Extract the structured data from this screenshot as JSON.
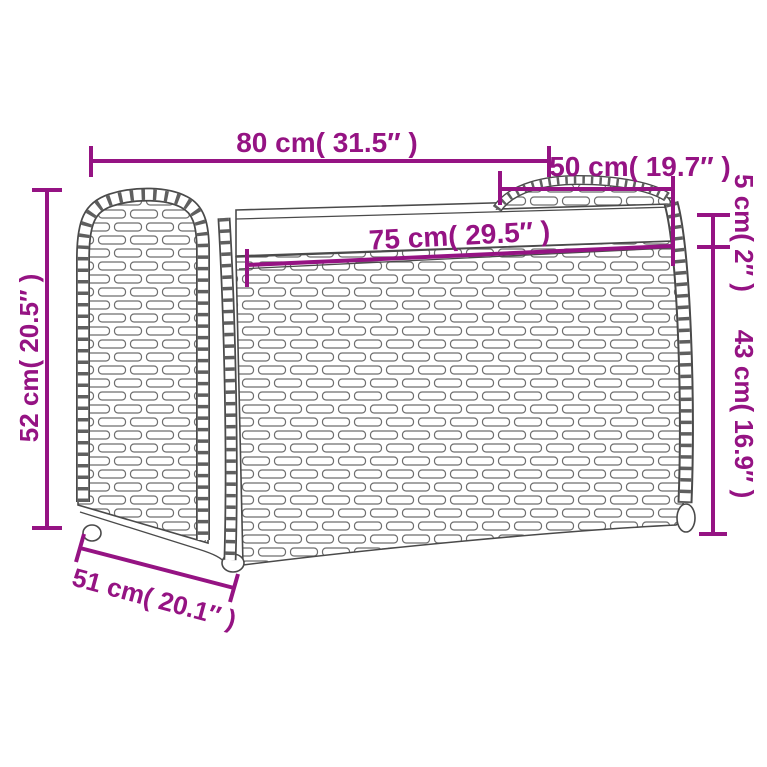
{
  "diagram": {
    "subject": "Rattan storage bench with seat cushion - dimension line drawing",
    "colors": {
      "accent": "#951383",
      "line_art": "#4a4a4a",
      "background": "#ffffff"
    },
    "dimensions": {
      "total_width": "80 cm( 31.5″ )",
      "lid_width": "50 cm( 19.7″ )",
      "inner_width": "75 cm( 29.5″ )",
      "lid_height": "5 cm( 2″ )",
      "side_height": "43 cm( 16.9″ )",
      "total_height": "52 cm( 20.5″ )",
      "depth": "51 cm( 20.1″ )"
    }
  }
}
